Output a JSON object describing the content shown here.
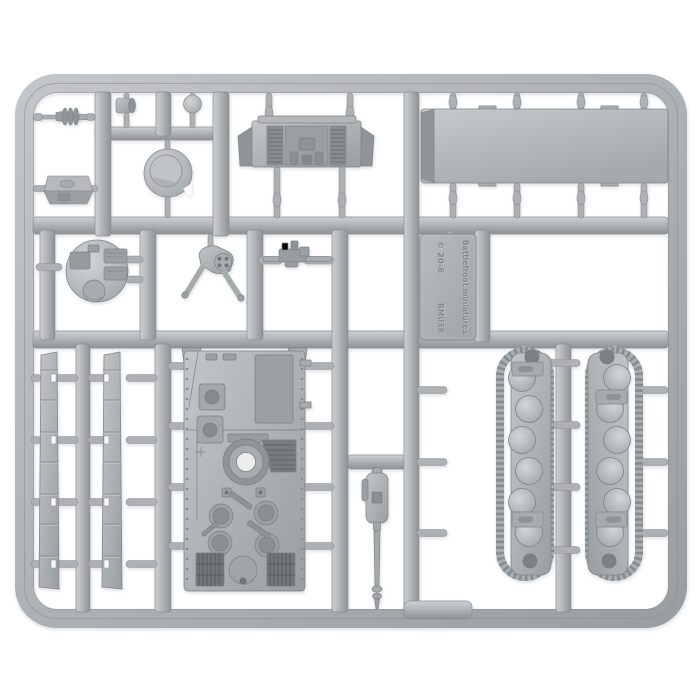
{
  "scene": {
    "subject": "injection-molded plastic model sprue with tank kit parts",
    "background": "#ffffff"
  },
  "plate": {
    "brand_text": "Battlefront miniatures",
    "copyright_line": "© 20-6",
    "sprue_code": "BMU58"
  },
  "colors": {
    "plastic_light": "#cdd0d2",
    "plastic_mid": "#b0b4b7",
    "plastic_dark": "#8c9194",
    "part_mid": "#a2a7ab",
    "part_dark": "#72777b",
    "hole_white": "#f2f3f4"
  },
  "parts": [
    "muzzle-brake",
    "periscope-knob-1",
    "periscope-knob-2",
    "cupola-box",
    "hatch-disc",
    "engine-deck",
    "roof-panel",
    "turret-top",
    "gun-tripod-mount",
    "machine-gun",
    "data-plate",
    "side-skirt-strip-1",
    "side-skirt-strip-2",
    "hull-top",
    "gun-barrel-mantlet",
    "track-assembly-left",
    "track-assembly-right"
  ]
}
